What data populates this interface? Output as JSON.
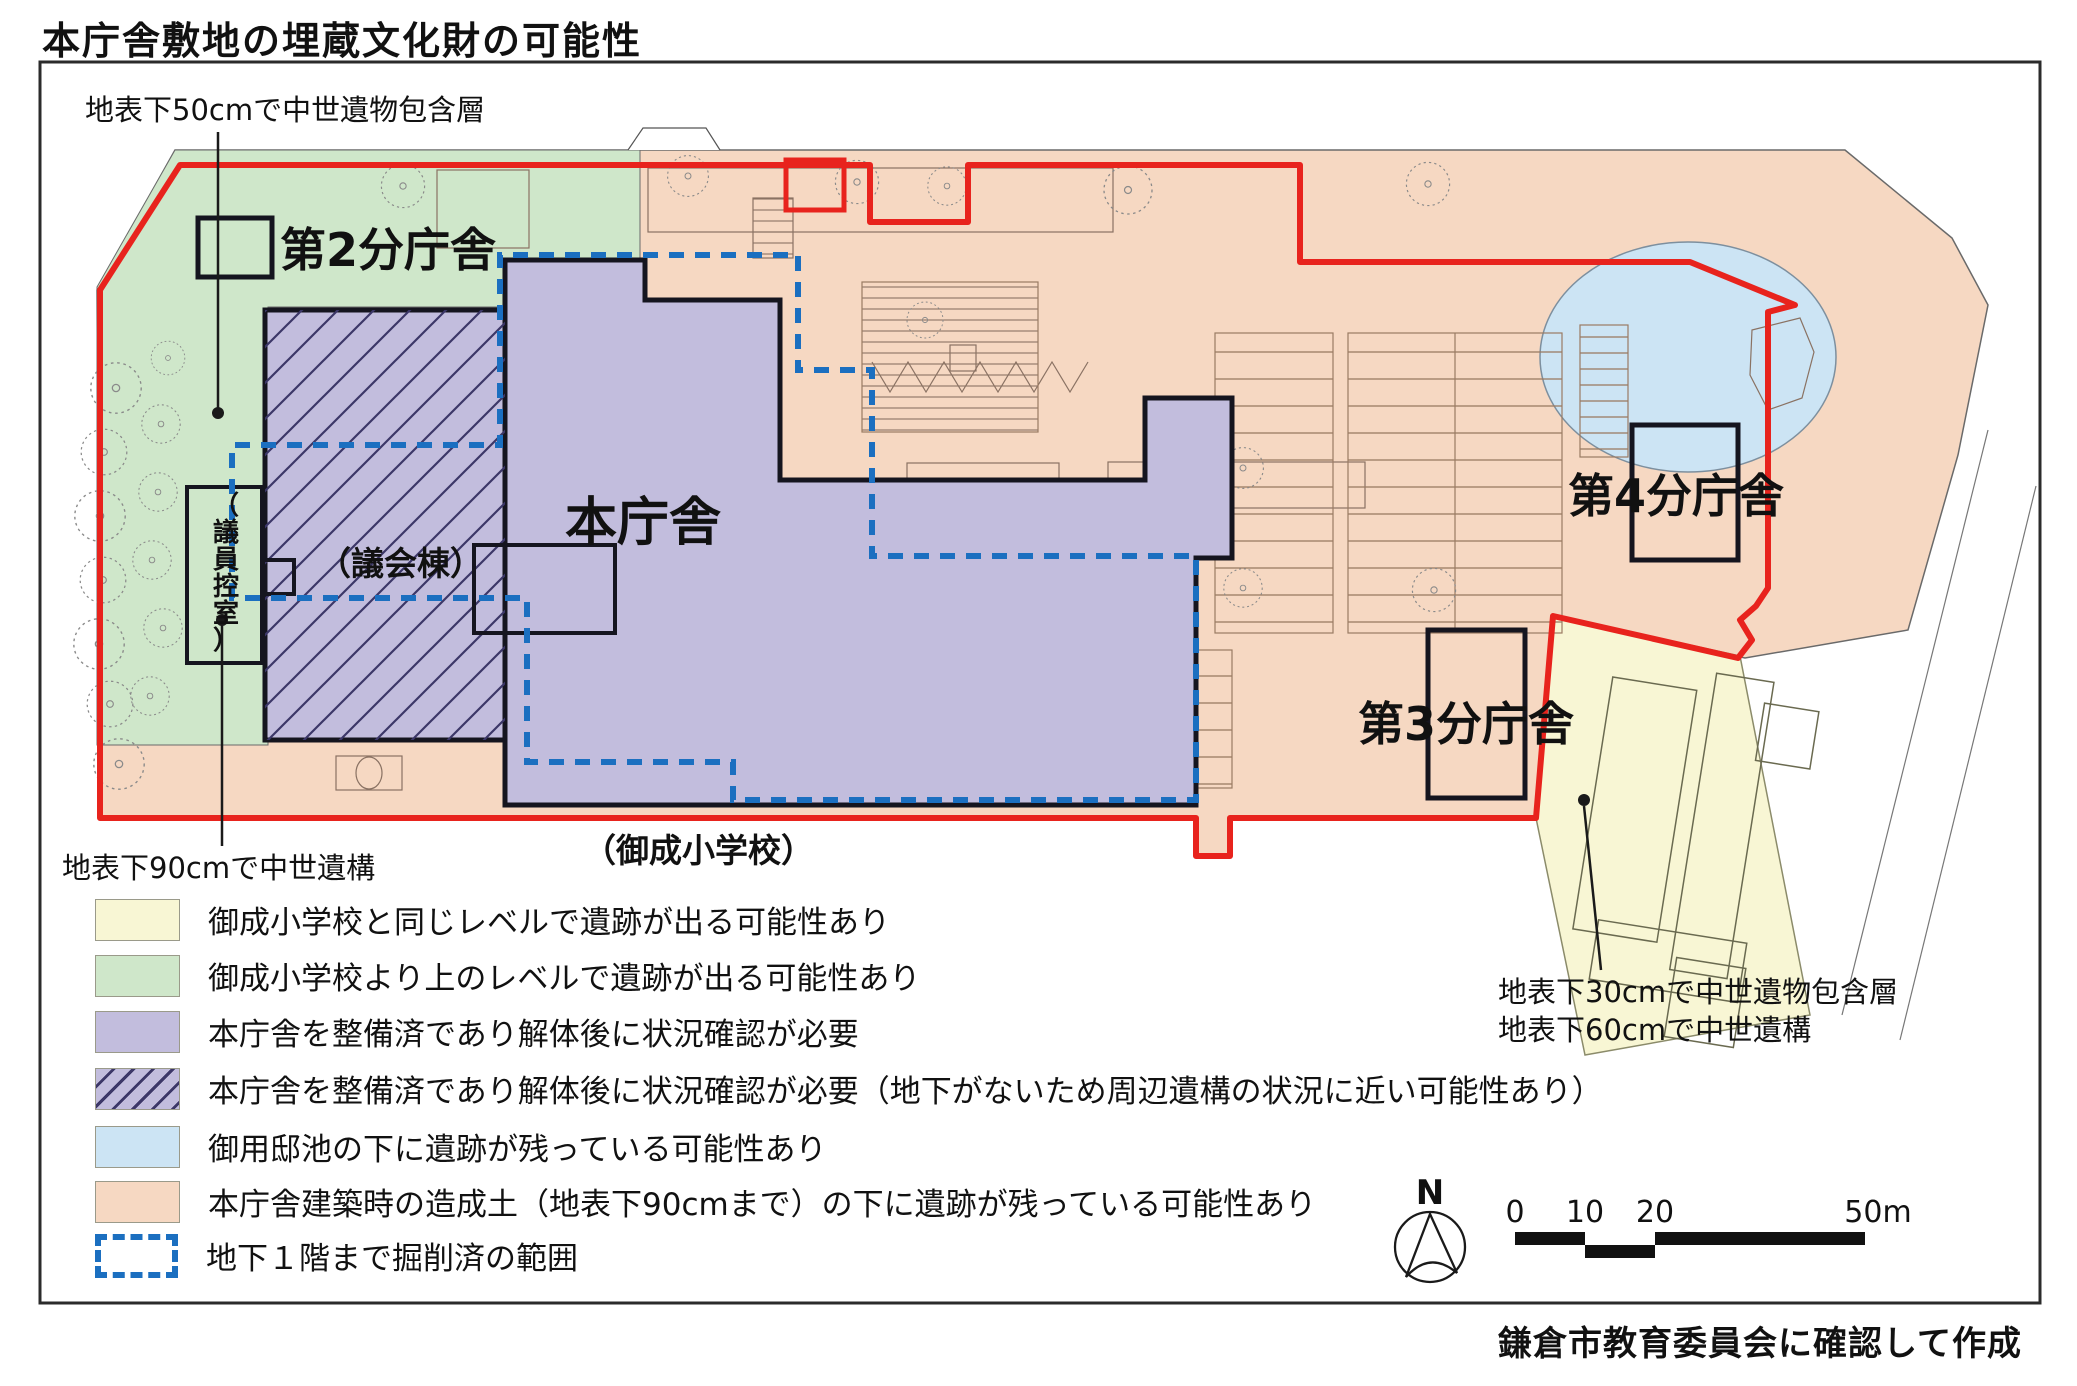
{
  "title": "本庁舎敷地の埋蔵文化財の可能性",
  "credit": "鎌倉市教育委員会に確認して作成",
  "map": {
    "labels": {
      "branch2": "第2分庁舎",
      "main_building": "本庁舎",
      "branch4": "第4分庁舎",
      "branch3": "第3分庁舎",
      "council_hall": "（議会棟）",
      "school": "（御成小学校）",
      "council_room_chars": [
        "（",
        "議",
        "員",
        "控",
        "室",
        "）"
      ]
    },
    "annotations": {
      "nw": "地表下50cmで中世遺物包含層",
      "sw": "地表下90cmで中世遺構",
      "se1": "地表下30cmで中世遺物包含層",
      "se2": "地表下60cmで中世遺構"
    },
    "north_label": "N",
    "scalebar": {
      "t0": "0",
      "t10": "10",
      "t20": "20",
      "t50": "50m"
    }
  },
  "legend": {
    "items": [
      {
        "key": "yellow",
        "color": "#f8f6d4",
        "label": "御成小学校と同じレベルで遺跡が出る可能性あり"
      },
      {
        "key": "green",
        "color": "#cfe7ca",
        "label": "御成小学校より上のレベルで遺跡が出る可能性あり"
      },
      {
        "key": "purple",
        "color": "#c2bddd",
        "label": "本庁舎を整備済であり解体後に状況確認が必要"
      },
      {
        "key": "purple-hatched",
        "color": "#c2bddd",
        "label": "本庁舎を整備済であり解体後に状況確認が必要（地下がないため周辺遺構の状況に近い可能性あり）"
      },
      {
        "key": "blue",
        "color": "#cce4f4",
        "label": "御用邸池の下に遺跡が残っている可能性あり"
      },
      {
        "key": "salmon",
        "color": "#f6d8c2",
        "label": "本庁舎建築時の造成土（地表下90cmまで）の下に遺跡が残っている可能性あり"
      },
      {
        "key": "excavated",
        "color": "#1b6fc0",
        "label": "地下１階まで掘削済の範囲"
      }
    ]
  },
  "colors": {
    "boundary_red": "#e8231d",
    "excavation_blue": "#1b6fc0",
    "building_outline": "#15151f",
    "site_detail": "#8a7263",
    "frame": "#2b2b2b"
  }
}
